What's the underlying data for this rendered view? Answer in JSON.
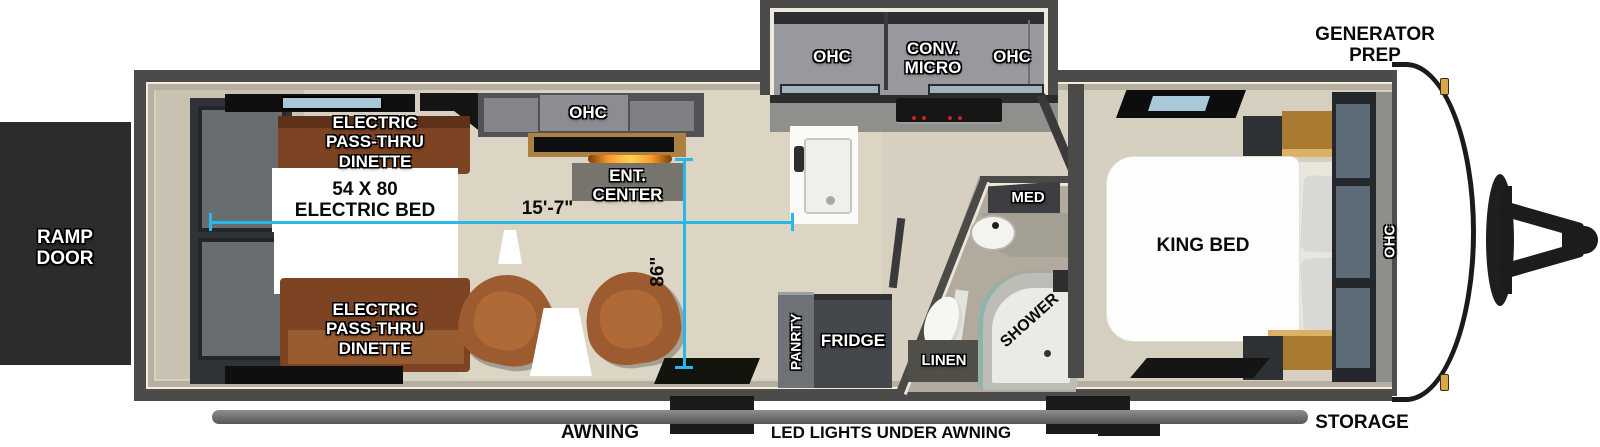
{
  "exterior": {
    "generator_prep": "GENERATOR\nPREP",
    "ramp_door": "RAMP\nDOOR",
    "storage": "STORAGE",
    "awning": "AWNING",
    "led_lights": "LED LIGHTS UNDER AWNING"
  },
  "dimensions": {
    "interior_length": "15'-7\"",
    "interior_width": "86\""
  },
  "garage": {
    "dinette_front": "ELECTRIC\nPASS-THRU\nDINETTE",
    "electric_bed": "54 X 80\nELECTRIC BED",
    "dinette_rear": "ELECTRIC\nPASS-THRU\nDINETTE"
  },
  "living": {
    "ohc": "OHC",
    "ent_center": "ENT.\nCENTER"
  },
  "kitchen": {
    "ohc_left": "OHC",
    "conv_micro": "CONV.\nMICRO",
    "ohc_right": "OHC",
    "pantry": "PANRTY",
    "fridge": "FRIDGE"
  },
  "bathroom": {
    "med": "MED",
    "linen": "LINEN",
    "shower": "SHOWER"
  },
  "bedroom": {
    "king_bed": "KING BED",
    "ohc": "OHC"
  },
  "colors": {
    "dimension_line": "#29b6e8",
    "wall": "#4b4b49",
    "floor": "#d7d0c1",
    "wood": "#7c4423",
    "cabinet_gray": "#97999e"
  }
}
